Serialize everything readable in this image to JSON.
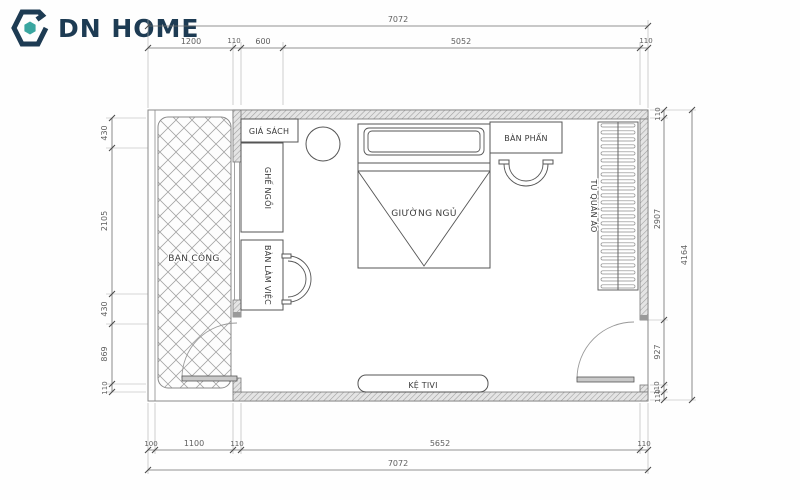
{
  "logo": {
    "brand": "DN HOME"
  },
  "colors": {
    "navy": "#1d3b53",
    "teal": "#3aa6a0"
  },
  "rooms": {
    "balcony": "BAN CÔNG",
    "bookshelf": "GIÁ SÁCH",
    "seat": "GHẾ NGỒI",
    "desk": "BÀN LÀM VIỆC",
    "bed": "GIƯỜNG NGỦ",
    "vanity": "BÀN PHẤN",
    "wardrobe": "TỦ QUẦN ÁO",
    "tv_shelf": "KỆ TIVI"
  },
  "dims": {
    "top_total": "7072",
    "top": [
      "1200",
      "110",
      "600",
      "5052",
      "110"
    ],
    "left": [
      "430",
      "2105",
      "430",
      "869",
      "110"
    ],
    "right": [
      "110",
      "2907",
      "927",
      "110",
      "110"
    ],
    "right_total": "4164",
    "bottom": [
      "100",
      "1100",
      "110",
      "5652",
      "110"
    ],
    "bottom_total": "7072",
    "window": "1400"
  }
}
